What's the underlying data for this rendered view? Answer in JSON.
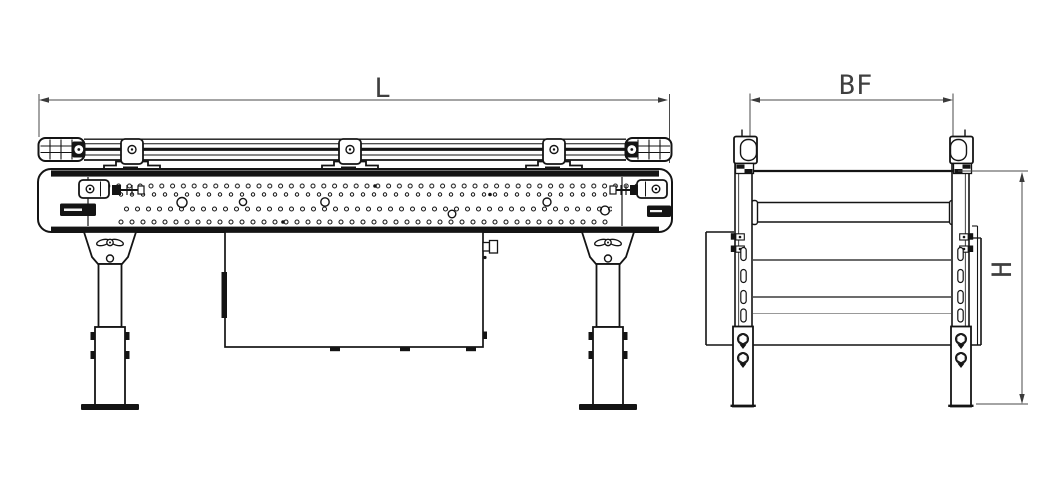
{
  "drawing": {
    "background": "#ffffff",
    "line_color": "#141414",
    "dimension_line_color": "#4a4a4a"
  },
  "dimension_labels": {
    "length": "L",
    "belt_width": "BF",
    "height": "H"
  }
}
